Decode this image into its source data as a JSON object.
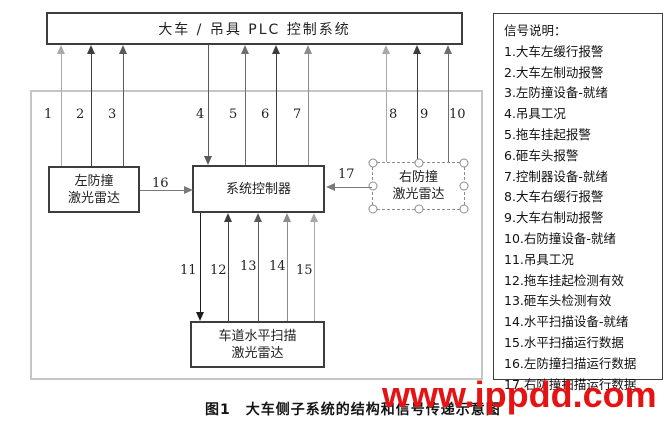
{
  "colors": {
    "watermark_red": "#e51313",
    "box_border": "#3d3d3d",
    "outer_frame_border": "#c6c6c6",
    "arrow_gray": "#7a7a7a"
  },
  "plc_box": {
    "title": "大车 / 吊具 PLC 控制系统"
  },
  "boxes": {
    "left_radar": {
      "line1": "左防撞",
      "line2": "激光雷达"
    },
    "controller": {
      "title": "系统控制器"
    },
    "right_radar": {
      "line1": "右防撞",
      "line2": "激光雷达"
    },
    "lane_scanner": {
      "line1": "车道水平扫描",
      "line2": "激光雷达"
    }
  },
  "signal_numbers": [
    "1",
    "2",
    "3",
    "4",
    "5",
    "6",
    "7",
    "8",
    "9",
    "10",
    "11",
    "12",
    "13",
    "14",
    "15",
    "16",
    "17"
  ],
  "legend": {
    "title": "信号说明：",
    "items": [
      "1.大车左缓行报警",
      "2.大车左制动报警",
      "3.左防撞设备-就绪",
      "4.吊具工况",
      "5.拖车挂起报警",
      "6.砸车头报警",
      "7.控制器设备-就绪",
      "8.大车右缓行报警",
      "9.大车右制动报警",
      "10.右防撞设备-就绪",
      "11.吊具工况",
      "12.拖车挂起检测有效",
      "13.砸车头检测有效",
      "14.水平扫描设备-就绪",
      "15.水平扫描运行数据",
      "16.左防撞扫描运行数据",
      "17.右防撞扫描运行数据"
    ]
  },
  "caption": "图1　大车侧子系统的结构和信号传递示意图",
  "watermark": "www.ippdd.com"
}
